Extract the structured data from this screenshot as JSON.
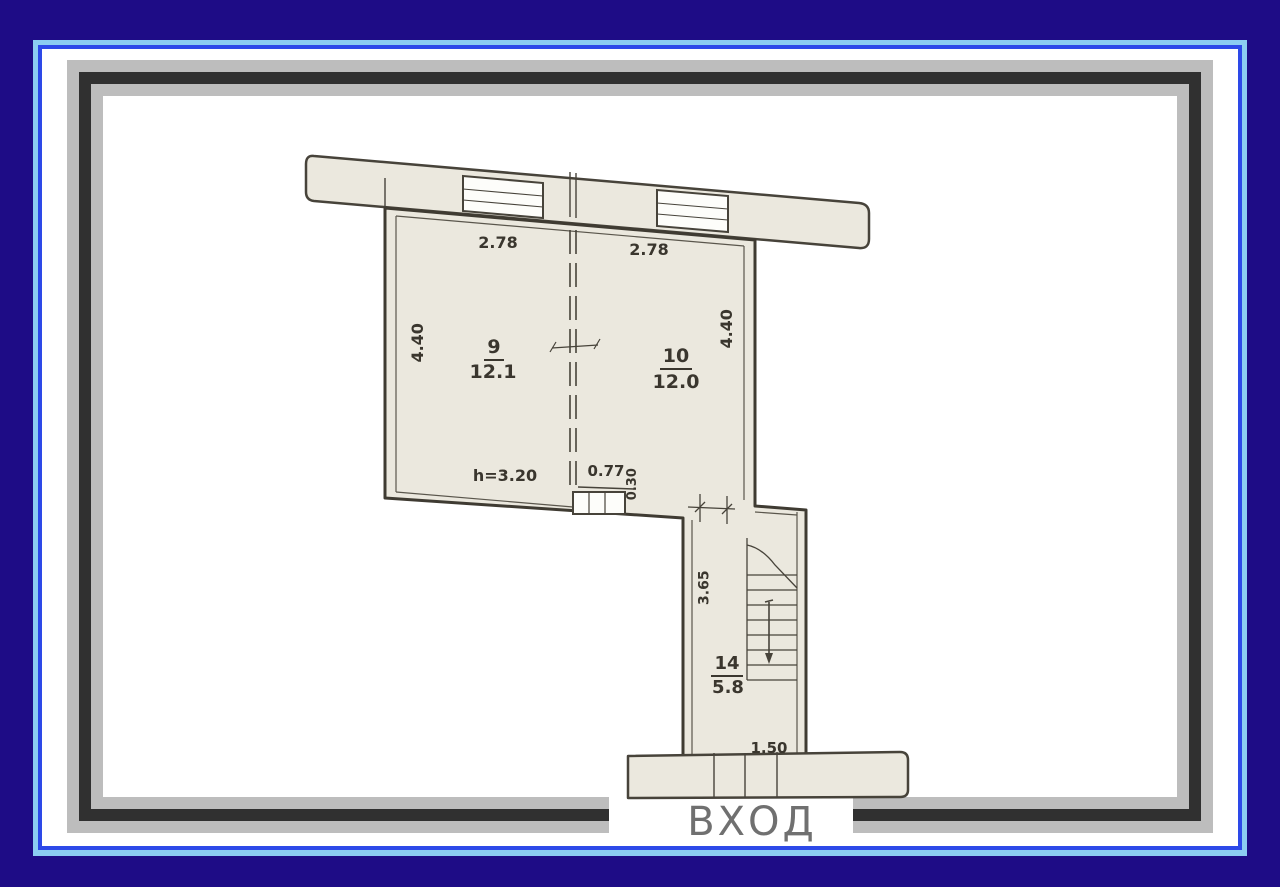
{
  "plan": {
    "entrance_label": "ВХОД",
    "rooms": [
      {
        "number": "9",
        "area": "12.1"
      },
      {
        "number": "10",
        "area": "12.0"
      },
      {
        "number": "14",
        "area": "5.8"
      }
    ],
    "dimensions": {
      "top_left_width": "2.78",
      "top_right_width": "2.78",
      "left_side_depth": "4.40",
      "right_side_depth": "4.40",
      "ceiling_height": "h=3.20",
      "opening_width": "0.77",
      "niche_depth": "0.30",
      "stairwell_length": "3.65",
      "entrance_width": "1.50"
    }
  },
  "colors": {
    "border_navy": "#1e0c86",
    "border_light_blue": "#8ccdf2",
    "border_royal_blue": "#2d49e8",
    "frame_gray": "#bdbdbd",
    "frame_dark": "#303030",
    "plan_paper": "#ebe8de",
    "plan_line": "#47433a",
    "entrance_text": "#707070"
  }
}
